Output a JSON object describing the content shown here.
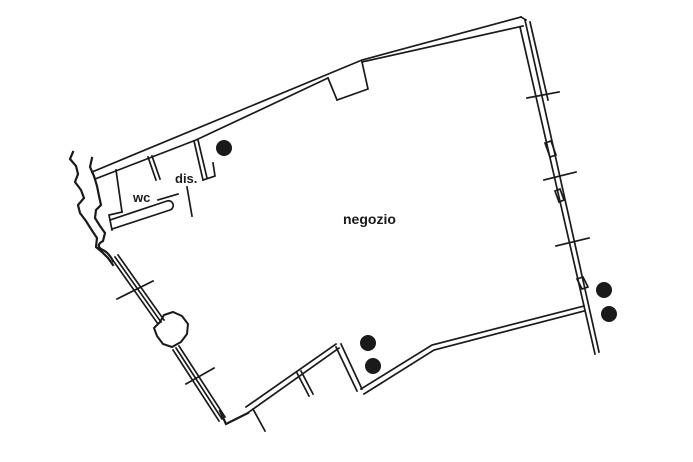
{
  "plan": {
    "type": "floor-plan",
    "colors": {
      "ink": "#1a1a1a",
      "paper": "#ffffff"
    },
    "labels": [
      {
        "id": "wc",
        "text": "wc",
        "x": 133,
        "y": 202,
        "size": 13
      },
      {
        "id": "dis",
        "text": "dis.",
        "x": 175,
        "y": 183,
        "size": 13
      },
      {
        "id": "negozio",
        "text": "negozio",
        "x": 343,
        "y": 224,
        "size": 14
      }
    ],
    "columns": [
      {
        "cx": 224,
        "cy": 148,
        "r": 8
      },
      {
        "cx": 604,
        "cy": 290,
        "r": 8
      },
      {
        "cx": 609,
        "cy": 314,
        "r": 8
      },
      {
        "cx": 368,
        "cy": 343,
        "r": 8
      },
      {
        "cx": 373,
        "cy": 366,
        "r": 8
      }
    ],
    "walls": [
      {
        "name": "top-wall-outer-line",
        "d": "M92,172 L362,60 L521,17"
      },
      {
        "name": "top-wall-left-cap",
        "d": "M92,172 L95,179"
      },
      {
        "name": "top-wall-inner-line-left",
        "d": "M95,179 L196,140 L328,78"
      },
      {
        "name": "top-wall-notch",
        "d": "M328,78 L337,100 L368,89 L362,62"
      },
      {
        "name": "top-wall-inner-line-right",
        "d": "M362,62 L523,26"
      },
      {
        "name": "top-wall-peak-join",
        "d": "M521,17 L526,20"
      },
      {
        "name": "right-wall-outer-line",
        "d": "M525,20 L599,352"
      },
      {
        "name": "right-wall-inner-line",
        "d": "M520,27 L595,354"
      },
      {
        "name": "right-wall-third-line",
        "d": "M530,22 L548,100"
      },
      {
        "name": "right-wall-window-1",
        "d": "M545,143 L551,141 L556,155 L550,157 Z"
      },
      {
        "name": "right-wall-window-2",
        "d": "M555,191 L560,189 L564,200 L559,202 Z"
      },
      {
        "name": "right-wall-window-3",
        "d": "M577,279 L583,277 L588,287 L582,289 Z"
      },
      {
        "name": "right-wall-tick-1",
        "d": "M527,98 L559,92"
      },
      {
        "name": "right-wall-tick-2",
        "d": "M544,180 L576,172"
      },
      {
        "name": "right-wall-tick-3",
        "d": "M556,246 L589,238"
      },
      {
        "name": "bottom-right-wall-upper",
        "d": "M361,389 L432,345 L584,306"
      },
      {
        "name": "bottom-right-wall-lower",
        "d": "M364,394 L434,350 L584,311"
      },
      {
        "name": "bottom-step-edge-1",
        "d": "M336,347 L357,391"
      },
      {
        "name": "bottom-step-edge-2",
        "d": "M341,344 L362,389"
      },
      {
        "name": "bottom-left-wall-upper",
        "d": "M246,407 L336,344"
      },
      {
        "name": "bottom-left-wall-lower",
        "d": "M249,412 L339,348"
      },
      {
        "name": "bottom-left-corner",
        "d": "M220,411 L226,424 L248,413",
        "w": 2.2
      },
      {
        "name": "bottom-door-swing-line",
        "d": "M253,409 L265,431"
      },
      {
        "name": "bottom-partition-stub-1",
        "d": "M297,373 L309,396"
      },
      {
        "name": "bottom-partition-stub-2",
        "d": "M301,371 L313,394"
      },
      {
        "name": "left-wall-upper-line-1",
        "d": "M112,259 L158,324"
      },
      {
        "name": "left-wall-upper-line-2",
        "d": "M115,257 L161,322"
      },
      {
        "name": "left-wall-upper-line-3",
        "d": "M118,255 L164,320"
      },
      {
        "name": "left-wall-lower-line-1",
        "d": "M173,350 L219,421"
      },
      {
        "name": "left-wall-lower-line-2",
        "d": "M176,348 L222,419"
      },
      {
        "name": "left-wall-lower-line-3",
        "d": "M179,346 L225,417"
      },
      {
        "name": "left-wall-tick-1",
        "d": "M117,299 L153,281"
      },
      {
        "name": "left-wall-tick-2",
        "d": "M186,384 L214,368"
      },
      {
        "name": "left-wall-pillar",
        "d": "M160,322 L164,315 L173,312 L182,316 L188,324 L187,334 L181,342 L172,347 L163,344 L157,336 L154,328 Z",
        "w": 2
      },
      {
        "name": "ruin-wall-west-edge",
        "d": "M73,152 L70,159 L76,166 L78,174 L75,182 L81,190 L84,198 L78,205 L80,213 L86,221 L91,229 L97,238 L96,247 L102,252 L108,258 L113,265",
        "w": 2.2
      },
      {
        "name": "ruin-wall-east-edge",
        "d": "M92,158 L90,167 L94,176 L97,186 L99,196 L101,205 L96,210 L95,218 L100,226 L105,233 L103,241 C99,243 97,246 101,249 C106,251 110,255 113,261",
        "w": 2.2
      },
      {
        "name": "wc-left-wall",
        "d": "M116,170 L122,212"
      },
      {
        "name": "wc-step-corner",
        "d": "M122,212 L109,215 L112,230"
      },
      {
        "name": "wc-counter",
        "d": "M112,229 L170,210 A4.5,4.5 0 0 0 167,201 L110,220"
      },
      {
        "name": "wc-dis-partition-line-1",
        "d": "M148,157 L156,180"
      },
      {
        "name": "wc-dis-partition-line-2",
        "d": "M152,156 L160,179"
      },
      {
        "name": "dis-right-wall-line-1",
        "d": "M194,141 L203,180"
      },
      {
        "name": "dis-right-wall-line-2",
        "d": "M198,140 L207,178"
      },
      {
        "name": "dis-right-wall-foot",
        "d": "M203,180 L215,176 L213,163"
      },
      {
        "name": "dis-door-line",
        "d": "M187,187 L192,216"
      },
      {
        "name": "wc-door-dash",
        "d": "M158,200 L178,194"
      }
    ]
  }
}
